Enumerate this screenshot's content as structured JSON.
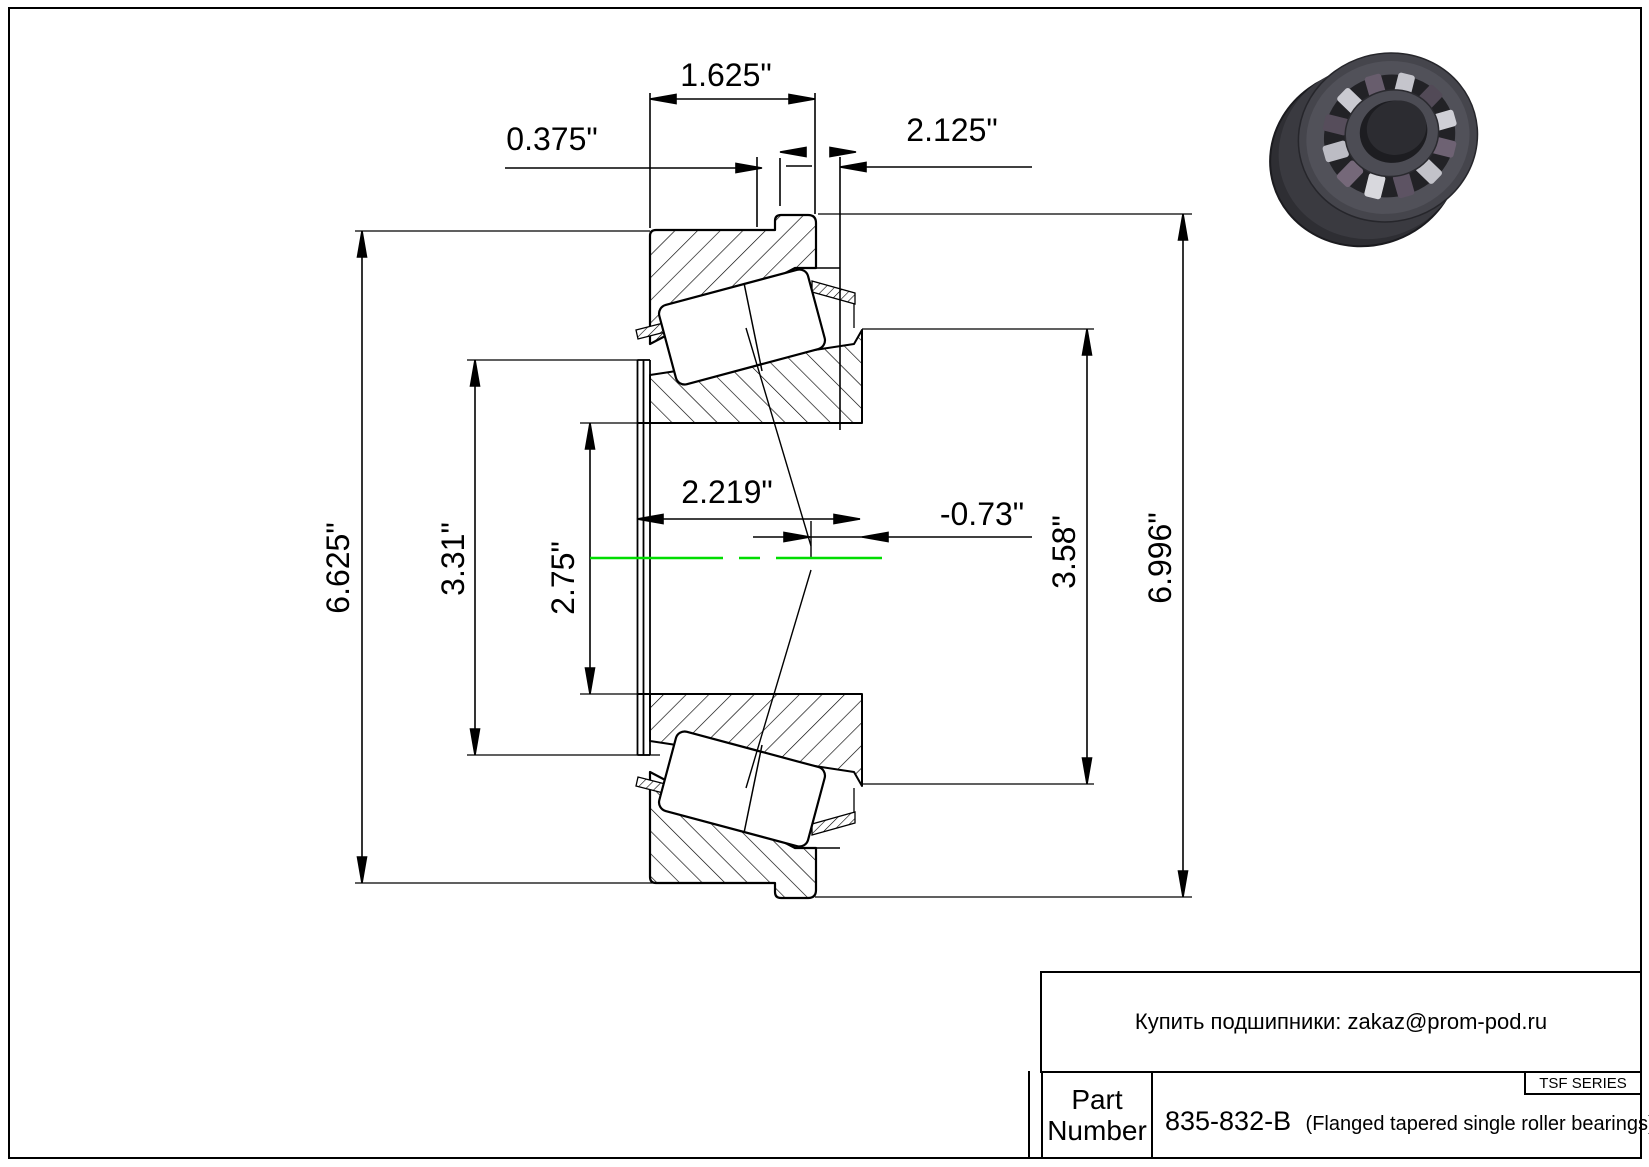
{
  "drawing": {
    "colors": {
      "line": "#000000",
      "centerline": "#00dd00",
      "background": "#ffffff"
    },
    "dimensions": {
      "width_1625": "1.625\"",
      "width_0375": "0.375\"",
      "width_2125": "2.125\"",
      "width_2219": "2.219\"",
      "offset_073": "-0.73\"",
      "dia_6625": "6.625\"",
      "dia_331": "3.31\"",
      "dia_275": "2.75\"",
      "dia_358": "3.58\"",
      "dia_6996": "6.996\""
    }
  },
  "title_block": {
    "vendor_note": "Купить подшипники: zakaz@prom-pod.ru",
    "part_label_line1": "Part",
    "part_label_line2": "Number",
    "part_number": "835-832-B",
    "part_description": "(Flanged tapered single roller bearings)",
    "series_label": "TSF SERIES"
  }
}
